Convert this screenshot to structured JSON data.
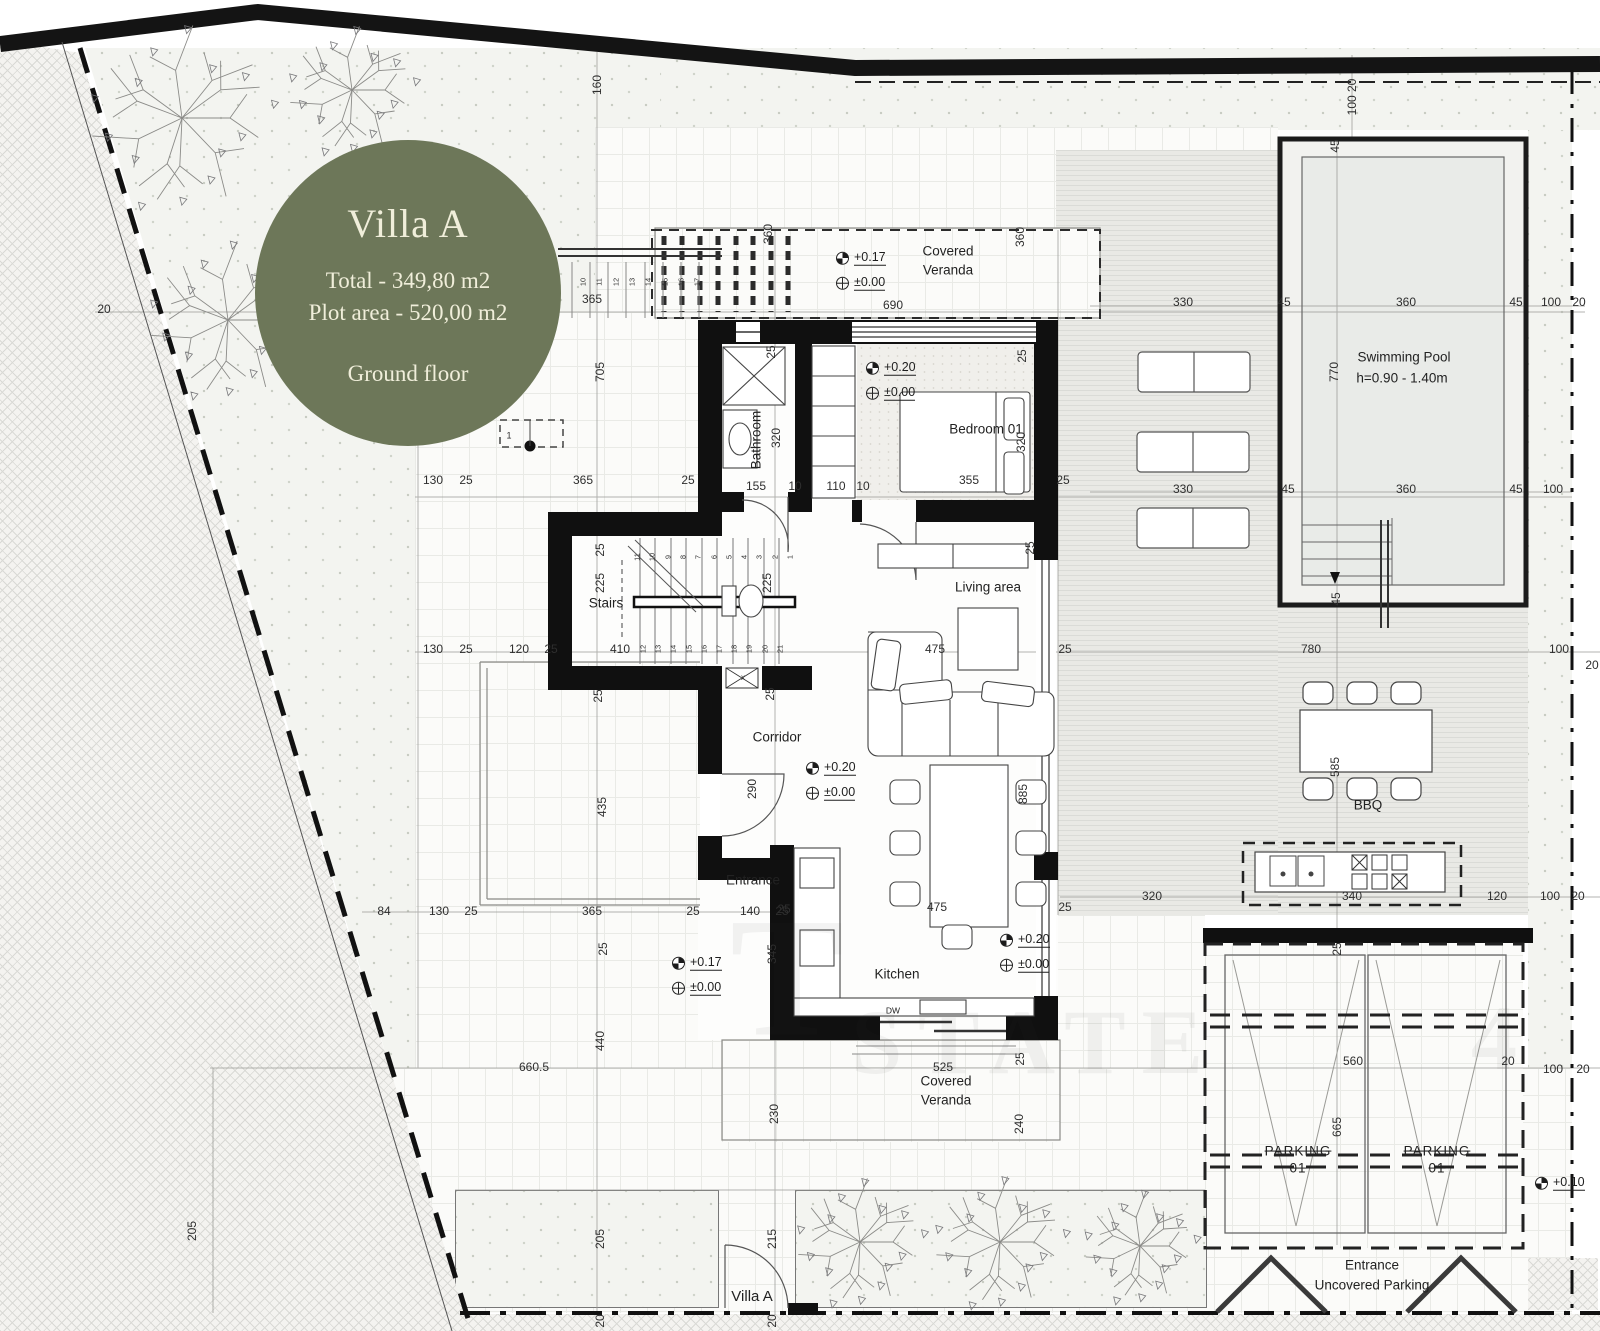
{
  "badge": {
    "title": "Villa A",
    "line1": "Total - 349,80 m2",
    "line2": "Plot area - 520,00 m2",
    "line3": "Ground floor",
    "bg": "#6d7759",
    "fg": "#f0eeda"
  },
  "rooms": [
    {
      "t": "Covered",
      "x": 948,
      "y": 252
    },
    {
      "t": "Veranda",
      "x": 948,
      "y": 271
    },
    {
      "t": "Bathroom",
      "x": 757,
      "y": 440,
      "r": 1
    },
    {
      "t": "Bedroom 01",
      "x": 986,
      "y": 430
    },
    {
      "t": "Stairs",
      "x": 606,
      "y": 604
    },
    {
      "t": "Corridor",
      "x": 777,
      "y": 738
    },
    {
      "t": "Living area",
      "x": 988,
      "y": 588
    },
    {
      "t": "Kitchen",
      "x": 897,
      "y": 975
    },
    {
      "t": "DW",
      "x": 893,
      "y": 1011,
      "s": 8.5
    },
    {
      "t": "Covered",
      "x": 946,
      "y": 1082
    },
    {
      "t": "Veranda",
      "x": 946,
      "y": 1101
    },
    {
      "t": "Swimming Pool",
      "x": 1404,
      "y": 358
    },
    {
      "t": "h=0.90 - 1.40m",
      "x": 1402,
      "y": 379
    },
    {
      "t": "BBQ",
      "x": 1368,
      "y": 806
    },
    {
      "t": "PARKING",
      "x": 1298,
      "y": 1152,
      "strike": 1
    },
    {
      "t": "01",
      "x": 1298,
      "y": 1169,
      "strike": 1
    },
    {
      "t": "PARKING",
      "x": 1437,
      "y": 1152,
      "strike": 1
    },
    {
      "t": "01",
      "x": 1437,
      "y": 1169,
      "strike": 1
    },
    {
      "t": "Entrance",
      "x": 753,
      "y": 881
    },
    {
      "t": "Entrance",
      "x": 1372,
      "y": 1266
    },
    {
      "t": "Uncovered Parking",
      "x": 1372,
      "y": 1286
    },
    {
      "t": "Villa A",
      "x": 752,
      "y": 1297,
      "s": 15
    }
  ],
  "dims": [
    {
      "t": "160",
      "x": 597,
      "y": 85,
      "r": 1
    },
    {
      "t": "100 20",
      "x": 1352,
      "y": 97,
      "r": 1
    },
    {
      "t": "360",
      "x": 768,
      "y": 234,
      "r": 1
    },
    {
      "t": "360",
      "x": 1020,
      "y": 237,
      "r": 1
    },
    {
      "t": "690",
      "x": 893,
      "y": 305
    },
    {
      "t": "365",
      "x": 592,
      "y": 299
    },
    {
      "t": "705",
      "x": 600,
      "y": 372,
      "r": 1
    },
    {
      "t": "20",
      "x": 104,
      "y": 309
    },
    {
      "t": "1",
      "x": 509,
      "y": 436,
      "s": 9
    },
    {
      "t": "330",
      "x": 1183,
      "y": 302
    },
    {
      "t": "45",
      "x": 1284,
      "y": 302
    },
    {
      "t": "360",
      "x": 1406,
      "y": 302
    },
    {
      "t": "45",
      "x": 1516,
      "y": 302
    },
    {
      "t": "100",
      "x": 1551,
      "y": 302
    },
    {
      "t": "20",
      "x": 1579,
      "y": 302
    },
    {
      "t": "45",
      "x": 1335,
      "y": 146,
      "r": 1
    },
    {
      "t": "770",
      "x": 1334,
      "y": 372,
      "r": 1
    },
    {
      "t": "45",
      "x": 1336,
      "y": 599,
      "r": 1
    },
    {
      "t": "330",
      "x": 1183,
      "y": 489
    },
    {
      "t": "45",
      "x": 1288,
      "y": 489
    },
    {
      "t": "360",
      "x": 1406,
      "y": 489
    },
    {
      "t": "45",
      "x": 1516,
      "y": 489
    },
    {
      "t": "100",
      "x": 1553,
      "y": 489
    },
    {
      "t": "130",
      "x": 433,
      "y": 480
    },
    {
      "t": "25",
      "x": 466,
      "y": 480
    },
    {
      "t": "365",
      "x": 583,
      "y": 480
    },
    {
      "t": "25",
      "x": 688,
      "y": 480
    },
    {
      "t": "155",
      "x": 756,
      "y": 486
    },
    {
      "t": "10",
      "x": 795,
      "y": 486
    },
    {
      "t": "110",
      "x": 836,
      "y": 486
    },
    {
      "t": "10",
      "x": 863,
      "y": 486
    },
    {
      "t": "355",
      "x": 969,
      "y": 480
    },
    {
      "t": "25",
      "x": 1063,
      "y": 480
    },
    {
      "t": "320",
      "x": 776,
      "y": 438,
      "r": 1
    },
    {
      "t": "320",
      "x": 1021,
      "y": 442,
      "r": 1
    },
    {
      "t": "25",
      "x": 771,
      "y": 352,
      "r": 1
    },
    {
      "t": "25",
      "x": 1022,
      "y": 356,
      "r": 1
    },
    {
      "t": "225",
      "x": 600,
      "y": 583,
      "r": 1
    },
    {
      "t": "225",
      "x": 767,
      "y": 583,
      "r": 1
    },
    {
      "t": "25",
      "x": 600,
      "y": 550,
      "r": 1
    },
    {
      "t": "410",
      "x": 620,
      "y": 649
    },
    {
      "t": "25",
      "x": 551,
      "y": 649
    },
    {
      "t": "130",
      "x": 433,
      "y": 649
    },
    {
      "t": "25",
      "x": 466,
      "y": 649
    },
    {
      "t": "120",
      "x": 519,
      "y": 649
    },
    {
      "t": "25",
      "x": 770,
      "y": 694,
      "r": 1
    },
    {
      "t": "290",
      "x": 752,
      "y": 789,
      "r": 1
    },
    {
      "t": "x",
      "x": 743,
      "y": 678,
      "s": 8
    },
    {
      "t": "475",
      "x": 935,
      "y": 649
    },
    {
      "t": "25",
      "x": 1065,
      "y": 649
    },
    {
      "t": "885",
      "x": 1023,
      "y": 794,
      "r": 1
    },
    {
      "t": "25",
      "x": 1030,
      "y": 548,
      "r": 1
    },
    {
      "t": "475",
      "x": 937,
      "y": 907
    },
    {
      "t": "25",
      "x": 1065,
      "y": 907
    },
    {
      "t": "25",
      "x": 784,
      "y": 909
    },
    {
      "t": "345",
      "x": 772,
      "y": 954,
      "r": 1
    },
    {
      "t": "525",
      "x": 943,
      "y": 1067
    },
    {
      "t": "25",
      "x": 1020,
      "y": 1059,
      "r": 1
    },
    {
      "t": "230",
      "x": 774,
      "y": 1114,
      "r": 1
    },
    {
      "t": "240",
      "x": 1019,
      "y": 1124,
      "r": 1
    },
    {
      "t": "435",
      "x": 602,
      "y": 807,
      "r": 1
    },
    {
      "t": "25",
      "x": 598,
      "y": 696,
      "r": 1
    },
    {
      "t": "84",
      "x": 384,
      "y": 911
    },
    {
      "t": "130",
      "x": 439,
      "y": 911
    },
    {
      "t": "25",
      "x": 471,
      "y": 911
    },
    {
      "t": "365",
      "x": 592,
      "y": 911
    },
    {
      "t": "25",
      "x": 693,
      "y": 911
    },
    {
      "t": "140",
      "x": 750,
      "y": 911
    },
    {
      "t": "25",
      "x": 782,
      "y": 911
    },
    {
      "t": "25",
      "x": 603,
      "y": 949,
      "r": 1
    },
    {
      "t": "440",
      "x": 600,
      "y": 1041,
      "r": 1
    },
    {
      "t": "660.5",
      "x": 534,
      "y": 1067
    },
    {
      "t": "780",
      "x": 1311,
      "y": 649
    },
    {
      "t": "100",
      "x": 1559,
      "y": 649
    },
    {
      "t": "20",
      "x": 1592,
      "y": 665
    },
    {
      "t": "585",
      "x": 1335,
      "y": 767,
      "r": 1
    },
    {
      "t": "320",
      "x": 1152,
      "y": 896
    },
    {
      "t": "340",
      "x": 1352,
      "y": 896
    },
    {
      "t": "120",
      "x": 1497,
      "y": 896
    },
    {
      "t": "100",
      "x": 1550,
      "y": 896
    },
    {
      "t": "20",
      "x": 1578,
      "y": 896
    },
    {
      "t": "25",
      "x": 1337,
      "y": 949,
      "r": 1
    },
    {
      "t": "560",
      "x": 1353,
      "y": 1061
    },
    {
      "t": "20",
      "x": 1508,
      "y": 1061
    },
    {
      "t": "100",
      "x": 1553,
      "y": 1069
    },
    {
      "t": "20",
      "x": 1583,
      "y": 1069
    },
    {
      "t": "665",
      "x": 1337,
      "y": 1127,
      "r": 1
    },
    {
      "t": "205",
      "x": 600,
      "y": 1239,
      "r": 1
    },
    {
      "t": "215",
      "x": 772,
      "y": 1239,
      "r": 1
    },
    {
      "t": "20",
      "x": 600,
      "y": 1321,
      "r": 1
    },
    {
      "t": "20",
      "x": 772,
      "y": 1321,
      "r": 1
    },
    {
      "t": "205",
      "x": 192,
      "y": 1231,
      "r": 1
    }
  ],
  "levels": [
    {
      "t": "+0.17",
      "cx": 842,
      "y": 258,
      "f": 1
    },
    {
      "t": "±0.00",
      "cx": 842,
      "y": 283
    },
    {
      "t": "+0.20",
      "cx": 872,
      "y": 368,
      "f": 1
    },
    {
      "t": "±0.00",
      "cx": 872,
      "y": 393
    },
    {
      "t": "+0.20",
      "cx": 812,
      "y": 768,
      "f": 1
    },
    {
      "t": "±0.00",
      "cx": 812,
      "y": 793
    },
    {
      "t": "+0.20",
      "cx": 1006,
      "y": 940,
      "f": 1
    },
    {
      "t": "±0.00",
      "cx": 1006,
      "y": 965
    },
    {
      "t": "+0.17",
      "cx": 678,
      "y": 963,
      "f": 1
    },
    {
      "t": "±0.00",
      "cx": 678,
      "y": 988
    },
    {
      "t": "+0.10",
      "cx": 1541,
      "y": 1183,
      "f": 1
    }
  ],
  "stairs": {
    "top": [
      "1",
      "2",
      "3",
      "4",
      "5",
      "6",
      "7",
      "8",
      "9",
      "10",
      "11"
    ],
    "bottom": [
      "12",
      "13",
      "14",
      "15",
      "16",
      "17",
      "18",
      "19",
      "20",
      "21"
    ],
    "out": [
      "10",
      "11",
      "12",
      "13",
      "14",
      "15",
      "16",
      "17"
    ]
  },
  "watermark": [
    {
      "t": "T",
      "x": 795,
      "y": 978,
      "s": 170
    },
    {
      "t": "STATE",
      "x": 1035,
      "y": 1042,
      "s": 92
    },
    {
      "t": "4",
      "x": 1502,
      "y": 1038,
      "s": 92
    }
  ],
  "colors": {
    "wall": "#111111",
    "line": "#444444",
    "badge_bg": "#6d7759",
    "badge_fg": "#f0eeda"
  }
}
